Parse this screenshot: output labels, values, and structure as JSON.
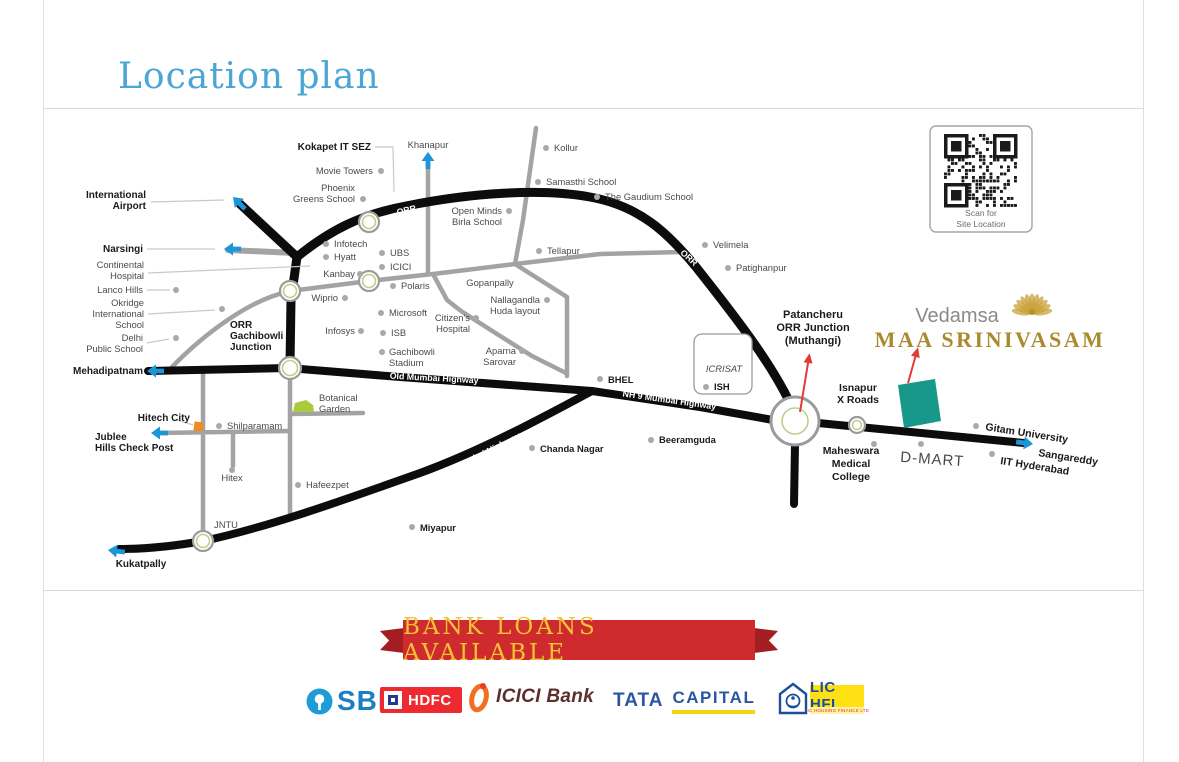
{
  "page": {
    "title": "Location plan"
  },
  "map": {
    "colors": {
      "highway": "#0c0c0c",
      "road": "#a3a3a3",
      "leader": "#c9c9c9",
      "dot": "#a9a9a9",
      "label": "#4a4a4a",
      "label_bold": "#1a1a1a",
      "road_label": "#ffffff",
      "junction_ring": "#9b9b9b",
      "junction_green": "#bcd088",
      "arrow_blue": "#1d96d8",
      "arrow_red": "#e23b33",
      "site_teal": "#17988a",
      "garden_green": "#a9ca3d",
      "marker_orange": "#f08c1e",
      "gold": "#a98b2e",
      "brand_gray": "#8a8a8a",
      "qr_dark": "#1a1a1a"
    },
    "roads_gray": [
      {
        "name": "narsingi-spur",
        "d": "M228,250 L295,253",
        "w": 6
      },
      {
        "name": "khanapur-road",
        "d": "M428,158 L428,273",
        "w": 4.5
      },
      {
        "name": "west-link",
        "d": "M172,367 C205,333 250,300 287,292",
        "w": 4.5
      },
      {
        "name": "gachibowli-cross-road",
        "d": "M290,291 L369,281 L433,274 L515,264",
        "w": 4.5
      },
      {
        "name": "tellapur-road",
        "d": "M515,264 L600,254 L682,252",
        "w": 4.5
      },
      {
        "name": "bhel-link-road",
        "d": "M515,264 L567,297 L567,376",
        "w": 4.5
      },
      {
        "name": "hospital-road",
        "d": "M433,274 L447,300 L461,311 L497,334 L532,356 L566,373",
        "w": 4.5
      },
      {
        "name": "kollur-road",
        "d": "M536,128 L523,220 L515,264",
        "w": 4.5
      },
      {
        "name": "jntu-road",
        "d": "M203,370 L203,540",
        "w": 4.5
      },
      {
        "name": "shilparamam-road",
        "d": "M290,379 L290,516",
        "w": 4.5
      },
      {
        "name": "jublee-road",
        "d": "M158,433 L290,431",
        "w": 4.5
      },
      {
        "name": "botanical-road",
        "d": "M290,414 L363,413",
        "w": 4.5
      },
      {
        "name": "hitex-stub",
        "d": "M233,433 L233,466",
        "w": 4.5
      }
    ],
    "roads_black": [
      {
        "name": "airport-spur",
        "d": "M240,204 L297,257",
        "w": 9
      },
      {
        "name": "orr",
        "d": "M297,257 C330,230 362,214 406,206 C470,193 540,188 590,197 C640,206 668,233 696,267 C738,320 770,362 789,401",
        "w": 9
      },
      {
        "name": "gachibowli-road",
        "d": "M297,257 L291,300 L290,365",
        "w": 9
      },
      {
        "name": "old-mumbai-highway",
        "d": "M148,371 L288,368 L400,377 L592,391",
        "w": 8
      },
      {
        "name": "nh9-upper",
        "d": "M592,391 L700,407 L773,420",
        "w": 8
      },
      {
        "name": "nh9-lower",
        "d": "M592,391 C540,419 480,451 420,473 C355,496 270,527 203,541 C175,546 145,549 119,549",
        "w": 8
      },
      {
        "name": "patancheru-south-road",
        "d": "M795,445 L794,504",
        "w": 8
      },
      {
        "name": "sangareddy-road",
        "d": "M818,423 L1024,443",
        "w": 8
      }
    ],
    "road_labels": [
      {
        "text": "ORR",
        "x": 407,
        "y": 213,
        "rotate": -13
      },
      {
        "text": "ORR",
        "x": 687,
        "y": 260,
        "rotate": 42
      },
      {
        "text": "Old Mumbai Highway",
        "x": 434,
        "y": 381,
        "rotate": 3
      },
      {
        "text": "NH 9 Mumbai Highway",
        "x": 669,
        "y": 403,
        "rotate": 8
      },
      {
        "text": "NH 9 Mumbai Highway",
        "x": 479,
        "y": 459,
        "rotate": -27
      }
    ],
    "junctions": [
      {
        "x": 369,
        "y": 222,
        "r": 10
      },
      {
        "x": 290,
        "y": 291,
        "r": 10
      },
      {
        "x": 369,
        "y": 281,
        "r": 10
      },
      {
        "x": 290,
        "y": 368,
        "r": 11
      },
      {
        "x": 203,
        "y": 541,
        "r": 10
      },
      {
        "x": 795,
        "y": 421,
        "r": 24,
        "inner": 13
      },
      {
        "x": 857,
        "y": 425,
        "r": 8
      }
    ],
    "leaders": [
      [
        [
          375,
          147
        ],
        [
          393,
          147
        ],
        [
          394,
          192
        ]
      ],
      [
        [
          151,
          202
        ],
        [
          224,
          200
        ]
      ],
      [
        [
          147,
          249
        ],
        [
          215,
          249
        ]
      ],
      [
        [
          148,
          273
        ],
        [
          310,
          266
        ]
      ],
      [
        [
          147,
          290
        ],
        [
          170,
          290
        ]
      ],
      [
        [
          148,
          314
        ],
        [
          215,
          310
        ]
      ],
      [
        [
          147,
          343
        ],
        [
          169,
          339
        ]
      ],
      [
        [
          177,
          420
        ],
        [
          193,
          425
        ]
      ]
    ],
    "places": [
      {
        "label": [
          "Kokapet IT SEZ"
        ],
        "x": 371,
        "y": 150,
        "anchor": "end",
        "bold": true,
        "size": 10
      },
      {
        "label": [
          "Movie Towers"
        ],
        "x": 373,
        "y": 174,
        "anchor": "end",
        "dot": [
          381,
          171
        ]
      },
      {
        "label": [
          "Phoenix",
          "Greens School"
        ],
        "x": 355,
        "y": 191,
        "anchor": "end",
        "dot": [
          363,
          199
        ]
      },
      {
        "label": [
          "Khanapur"
        ],
        "x": 428,
        "y": 148,
        "anchor": "middle"
      },
      {
        "label": [
          "Kollur"
        ],
        "x": 554,
        "y": 151,
        "anchor": "start",
        "dot": [
          546,
          148
        ]
      },
      {
        "label": [
          "Samasthi School"
        ],
        "x": 546,
        "y": 185,
        "anchor": "start",
        "dot": [
          538,
          182
        ]
      },
      {
        "label": [
          "The Gaudium School"
        ],
        "x": 605,
        "y": 200,
        "anchor": "start",
        "dot": [
          597,
          197
        ]
      },
      {
        "label": [
          "Open Minds",
          "Birla School"
        ],
        "x": 502,
        "y": 214,
        "anchor": "end",
        "dot": [
          509,
          211
        ]
      },
      {
        "label": [
          "Tellapur"
        ],
        "x": 547,
        "y": 254,
        "anchor": "start",
        "dot": [
          539,
          251
        ]
      },
      {
        "label": [
          "Velimela"
        ],
        "x": 713,
        "y": 248,
        "anchor": "start",
        "dot": [
          705,
          245
        ]
      },
      {
        "label": [
          "Patighanpur"
        ],
        "x": 736,
        "y": 271,
        "anchor": "start",
        "dot": [
          728,
          268
        ]
      },
      {
        "label": [
          "Infotech"
        ],
        "x": 334,
        "y": 247,
        "anchor": "start",
        "dot": [
          326,
          244
        ]
      },
      {
        "label": [
          "Hyatt"
        ],
        "x": 334,
        "y": 260,
        "anchor": "start",
        "dot": [
          326,
          257
        ]
      },
      {
        "label": [
          "UBS"
        ],
        "x": 390,
        "y": 256,
        "anchor": "start",
        "dot": [
          382,
          253
        ]
      },
      {
        "label": [
          "ICICI"
        ],
        "x": 390,
        "y": 270,
        "anchor": "start",
        "dot": [
          382,
          267
        ]
      },
      {
        "label": [
          "Kanbay"
        ],
        "x": 355,
        "y": 277,
        "anchor": "end",
        "dot": [
          360,
          274
        ]
      },
      {
        "label": [
          "Wiprio"
        ],
        "x": 338,
        "y": 301,
        "anchor": "end",
        "dot": [
          345,
          298
        ]
      },
      {
        "label": [
          "Polaris"
        ],
        "x": 401,
        "y": 289,
        "anchor": "start",
        "dot": [
          393,
          286
        ]
      },
      {
        "label": [
          "Microsoft"
        ],
        "x": 389,
        "y": 316,
        "anchor": "start",
        "dot": [
          381,
          313
        ]
      },
      {
        "label": [
          "ISB"
        ],
        "x": 391,
        "y": 336,
        "anchor": "start",
        "dot": [
          383,
          333
        ]
      },
      {
        "label": [
          "Infosys"
        ],
        "x": 355,
        "y": 334,
        "anchor": "end",
        "dot": [
          361,
          331
        ]
      },
      {
        "label": [
          "Gachibowli",
          "Stadium"
        ],
        "x": 389,
        "y": 355,
        "anchor": "start",
        "dot": [
          382,
          352
        ]
      },
      {
        "label": [
          "Citizen's",
          "Hospital"
        ],
        "x": 470,
        "y": 321,
        "anchor": "end",
        "dot": [
          476,
          318
        ]
      },
      {
        "label": [
          "Gopanpally"
        ],
        "x": 490,
        "y": 286,
        "anchor": "middle"
      },
      {
        "label": [
          "Nallagandla",
          "Huda layout"
        ],
        "x": 540,
        "y": 303,
        "anchor": "end",
        "dot": [
          547,
          300
        ]
      },
      {
        "label": [
          "Aparna",
          "Sarovar"
        ],
        "x": 516,
        "y": 354,
        "anchor": "end",
        "dot": [
          522,
          351
        ]
      },
      {
        "label": [
          "BHEL"
        ],
        "x": 608,
        "y": 383,
        "anchor": "start",
        "bold": true,
        "dot": [
          600,
          379
        ]
      },
      {
        "label": [
          "Chanda Nagar"
        ],
        "x": 540,
        "y": 452,
        "anchor": "start",
        "bold": true,
        "dot": [
          532,
          448
        ]
      },
      {
        "label": [
          "Beeramguda"
        ],
        "x": 659,
        "y": 443,
        "anchor": "start",
        "bold": true,
        "dot": [
          651,
          440
        ]
      },
      {
        "label": [
          "Miyapur"
        ],
        "x": 420,
        "y": 531,
        "anchor": "start",
        "bold": true,
        "dot": [
          412,
          527
        ]
      },
      {
        "label": [
          "International",
          "Airport"
        ],
        "x": 146,
        "y": 198,
        "anchor": "end",
        "bold": true,
        "size": 10
      },
      {
        "label": [
          "Narsingi"
        ],
        "x": 143,
        "y": 252,
        "anchor": "end",
        "bold": true,
        "size": 10
      },
      {
        "label": [
          "Continental",
          "Hospital"
        ],
        "x": 144,
        "y": 268,
        "anchor": "end"
      },
      {
        "label": [
          "Lanco Hills"
        ],
        "x": 143,
        "y": 293,
        "anchor": "end",
        "dot": [
          176,
          290
        ]
      },
      {
        "label": [
          "Okridge",
          "International",
          "School"
        ],
        "x": 144,
        "y": 306,
        "anchor": "end",
        "dot": [
          222,
          309
        ]
      },
      {
        "label": [
          "Delhi",
          "Public School"
        ],
        "x": 143,
        "y": 341,
        "anchor": "end",
        "dot": [
          176,
          338
        ]
      },
      {
        "label": [
          "Mehadipatnam"
        ],
        "x": 143,
        "y": 374,
        "anchor": "end",
        "bold": true,
        "size": 10
      },
      {
        "label": [
          "ORR",
          "Gachibowli",
          "Junction"
        ],
        "x": 230,
        "y": 328,
        "anchor": "start",
        "bold": true,
        "size": 10
      },
      {
        "label": [
          "Botanical",
          "Garden"
        ],
        "x": 319,
        "y": 401,
        "anchor": "start"
      },
      {
        "label": [
          "Hitech City"
        ],
        "x": 190,
        "y": 421,
        "anchor": "end",
        "bold": true,
        "size": 10
      },
      {
        "label": [
          "Shilparamam"
        ],
        "x": 227,
        "y": 429,
        "anchor": "start",
        "dot": [
          219,
          426
        ]
      },
      {
        "label": [
          "Jublee",
          "Hills Check Post"
        ],
        "x": 95,
        "y": 440,
        "anchor": "start",
        "bold": true,
        "size": 10
      },
      {
        "label": [
          "Hitex"
        ],
        "x": 232,
        "y": 481,
        "anchor": "middle",
        "dot": [
          232,
          470
        ]
      },
      {
        "label": [
          "Hafeezpet"
        ],
        "x": 306,
        "y": 488,
        "anchor": "start",
        "dot": [
          298,
          485
        ]
      },
      {
        "label": [
          "JNTU"
        ],
        "x": 214,
        "y": 528,
        "anchor": "start"
      },
      {
        "label": [
          "Kukatpally"
        ],
        "x": 141,
        "y": 567,
        "anchor": "middle",
        "bold": true,
        "size": 10
      },
      {
        "label": [
          "Patancheru",
          "ORR Junction",
          "(Muthangi)"
        ],
        "x": 813,
        "y": 318,
        "anchor": "middle",
        "bold": true,
        "size": 11,
        "lh": 13
      },
      {
        "label": [
          "Isnapur",
          "X Roads"
        ],
        "x": 858,
        "y": 391,
        "anchor": "middle",
        "bold": true,
        "size": 10.5,
        "lh": 12
      },
      {
        "label": [
          "Maheswara",
          "Medical",
          "College"
        ],
        "x": 851,
        "y": 454,
        "anchor": "middle",
        "bold": true,
        "size": 10.5,
        "lh": 13
      },
      {
        "label": [
          "Gitam University"
        ],
        "x": 985,
        "y": 430,
        "anchor": "start",
        "bold": true,
        "size": 10.5,
        "rotate": 9,
        "dot": [
          976,
          426
        ]
      },
      {
        "label": [
          "Sangareddy"
        ],
        "x": 1038,
        "y": 456,
        "anchor": "start",
        "bold": true,
        "size": 10.5,
        "rotate": 9
      },
      {
        "label": [
          "IIT Hyderabad"
        ],
        "x": 1000,
        "y": 464,
        "anchor": "start",
        "bold": true,
        "size": 10.5,
        "rotate": 9,
        "dot": [
          992,
          454
        ]
      },
      {
        "label": [
          "D-MART"
        ],
        "x": 932,
        "y": 464,
        "anchor": "middle",
        "size": 15,
        "rotate": 4,
        "spacing": 1,
        "dot": [
          921,
          444
        ]
      },
      {
        "label": [
          "ICRISAT"
        ],
        "x": 724,
        "y": 372,
        "anchor": "middle",
        "italic": true
      },
      {
        "label": [
          "ISH"
        ],
        "x": 714,
        "y": 390,
        "anchor": "start",
        "bold": true,
        "dot": [
          706,
          387
        ]
      }
    ],
    "extra_dots": [
      [
        874,
        444
      ]
    ],
    "blue_arrows": [
      {
        "name": "international-airport-arrow",
        "x": 233,
        "y": 197,
        "angle": -135
      },
      {
        "name": "narsingi-arrow",
        "x": 224,
        "y": 249,
        "angle": 180
      },
      {
        "name": "khanapur-arrow",
        "x": 428,
        "y": 152,
        "angle": -90
      },
      {
        "name": "mehadipatnam-arrow",
        "x": 147,
        "y": 371,
        "angle": 180
      },
      {
        "name": "jublee-hills-arrow",
        "x": 151,
        "y": 433,
        "angle": 180
      },
      {
        "name": "kukatpally-arrow",
        "x": 108,
        "y": 550,
        "angle": 187
      },
      {
        "name": "sangareddy-arrow",
        "x": 1033,
        "y": 444,
        "angle": 7
      }
    ],
    "red_arrows": [
      {
        "name": "patancheru-junction-pointer",
        "x1": 800,
        "y1": 412,
        "x2": 809,
        "y2": 357
      },
      {
        "name": "site-pointer",
        "x1": 908,
        "y1": 383,
        "x2": 917,
        "y2": 351
      }
    ],
    "site": {
      "points": "898,385 935,379 941,421 904,428"
    },
    "garden": {
      "points": "293,412 295,403 306,400 313,405 314,412"
    },
    "orange_marker": {
      "x": 194,
      "y": 422,
      "w": 9,
      "h": 9,
      "rotate": 8
    },
    "icrisat_box": {
      "x": 694,
      "y": 334,
      "w": 58,
      "h": 60,
      "r": 8
    },
    "qr": {
      "x": 930,
      "y": 126,
      "w": 102,
      "h": 106,
      "caption": [
        "Scan for",
        "Site Location"
      ]
    },
    "project": {
      "brand": "Vedamsa",
      "name": "MAA SRINIVASAM",
      "brand_x": 957,
      "brand_y": 322,
      "name_x": 990,
      "name_y": 347,
      "lotus_x": 1032,
      "lotus_y": 314
    }
  },
  "banner": {
    "text": "BANK LOANS AVAILABLE"
  },
  "banks": [
    {
      "id": "sbi",
      "label": "SBI"
    },
    {
      "id": "hdfc",
      "label": "HDFC"
    },
    {
      "id": "icici",
      "label": "ICICI Bank"
    },
    {
      "id": "tata",
      "label_primary": "TATA",
      "label_secondary": "CAPITAL"
    },
    {
      "id": "lichfl",
      "label": "LIC HFL",
      "caption": "LIC HOUSING FINANCE LTD"
    }
  ]
}
